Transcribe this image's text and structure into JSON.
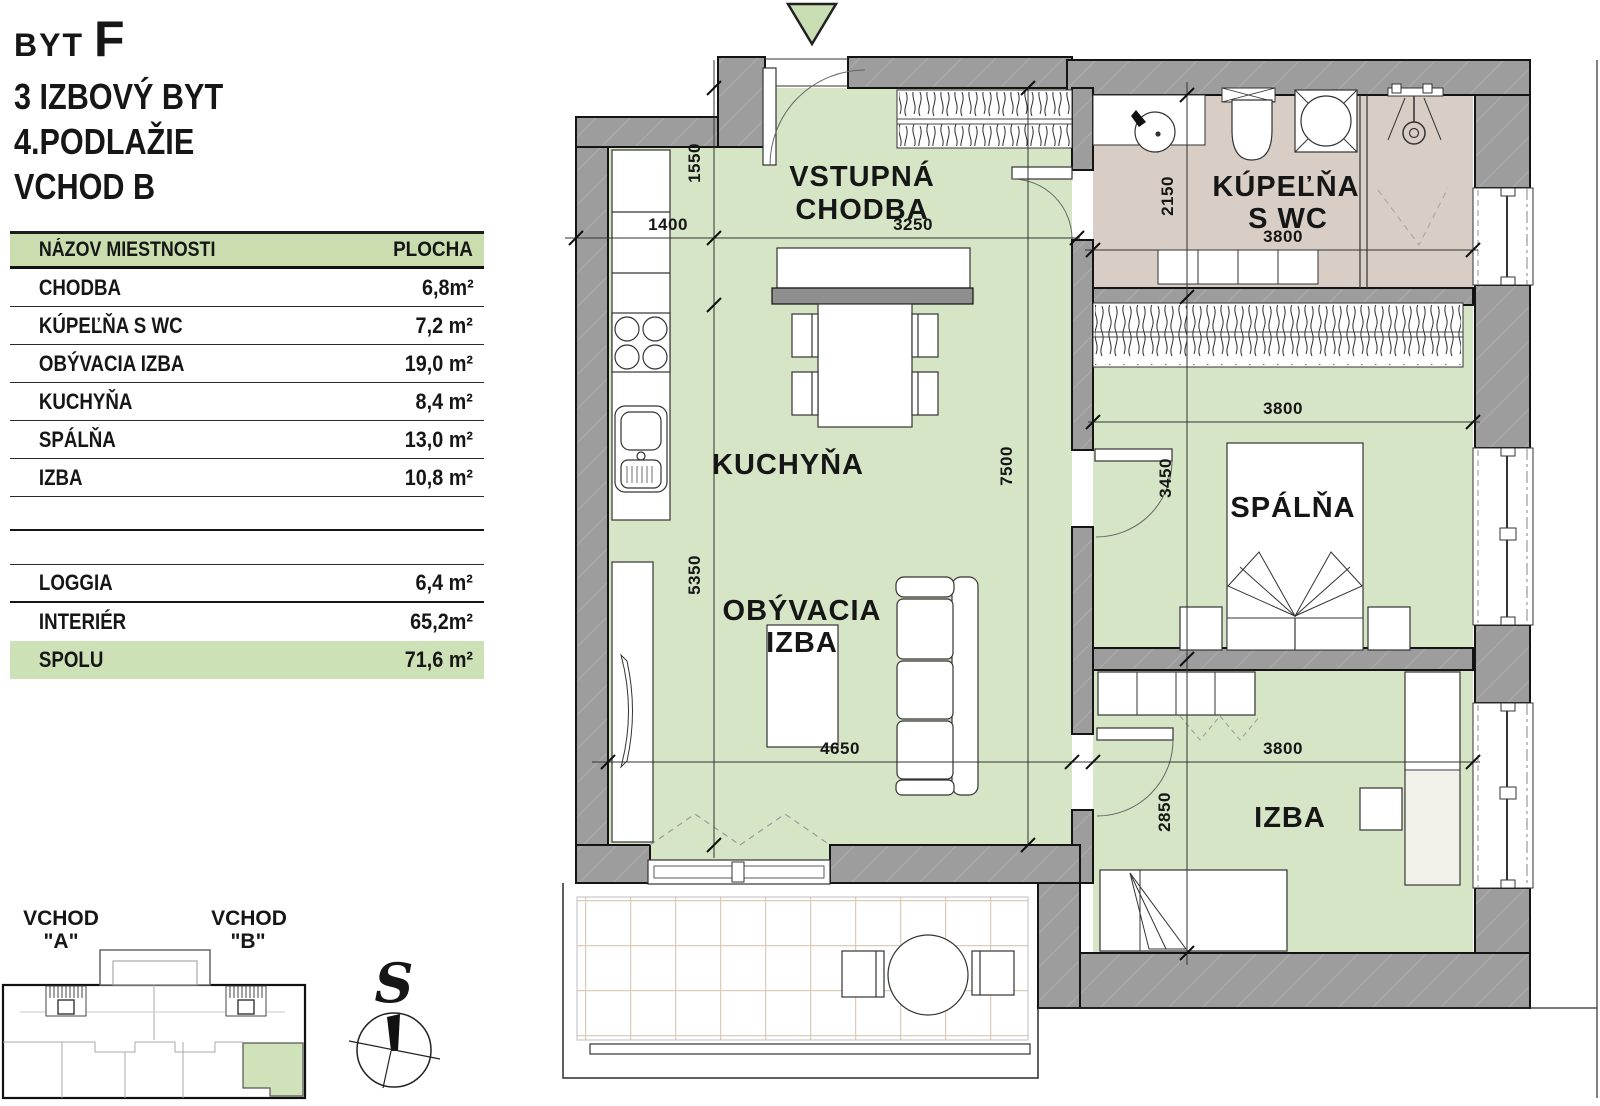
{
  "header": {
    "byt_label": "BYT",
    "unit": "F",
    "type": "3 IZBOVÝ BYT",
    "floor": "4.PODLAŽIE",
    "entrance": "VCHOD B"
  },
  "table": {
    "col_name": "NÁZOV MIESTNOSTI",
    "col_area": "PLOCHA",
    "rows": [
      {
        "name": "CHODBA",
        "area": "6,8m²"
      },
      {
        "name": "KÚPEĽŇA S WC",
        "area": "7,2 m²"
      },
      {
        "name": "OBÝVACIA IZBA",
        "area": "19,0 m²"
      },
      {
        "name": "KUCHYŇA",
        "area": "8,4 m²"
      },
      {
        "name": "SPÁLŇA",
        "area": "13,0 m²"
      },
      {
        "name": "IZBA",
        "area": "10,8 m²"
      }
    ],
    "loggia": {
      "name": "LOGGIA",
      "area": "6,4 m²"
    },
    "interier": {
      "name": "INTERIÉR",
      "area": "65,2m²"
    },
    "total": {
      "name": "SPOLU",
      "area": "71,6 m²"
    }
  },
  "plan": {
    "rooms": {
      "vstupna": {
        "l1": "VSTUPNÁ",
        "l2": "CHODBA"
      },
      "kuchyna": {
        "l1": "KUCHYŇA"
      },
      "obyvacia": {
        "l1": "OBÝVACIA",
        "l2": "IZBA"
      },
      "kupelna": {
        "l1": "KÚPEĽŇA",
        "l2": "S WC"
      },
      "spalna": {
        "l1": "SPÁLŇA"
      },
      "izba": {
        "l1": "IZBA"
      }
    },
    "dims": {
      "k1400": "1400",
      "k1550": "1550",
      "k3250": "3250",
      "k2150": "2150",
      "k3800a": "3800",
      "k7500": "7500",
      "k3450": "3450",
      "k5350": "5350",
      "k4650": "4650",
      "k3800b": "3800",
      "k3800c": "3800",
      "k2850": "2850"
    }
  },
  "keymap": {
    "vchod_a1": "VCHOD",
    "vchod_a2": "\"A\"",
    "vchod_b1": "VCHOD",
    "vchod_b2": "\"B\""
  },
  "compass": {
    "north": "S"
  },
  "colors": {
    "floor_green": "#d6e5c6",
    "bath_floor": "#d9cec5",
    "wall_gray": "#9d9d9d",
    "header_green": "#c9ddae",
    "total_row_green": "#cde1b6",
    "keymap_green": "#cfe2ba"
  }
}
